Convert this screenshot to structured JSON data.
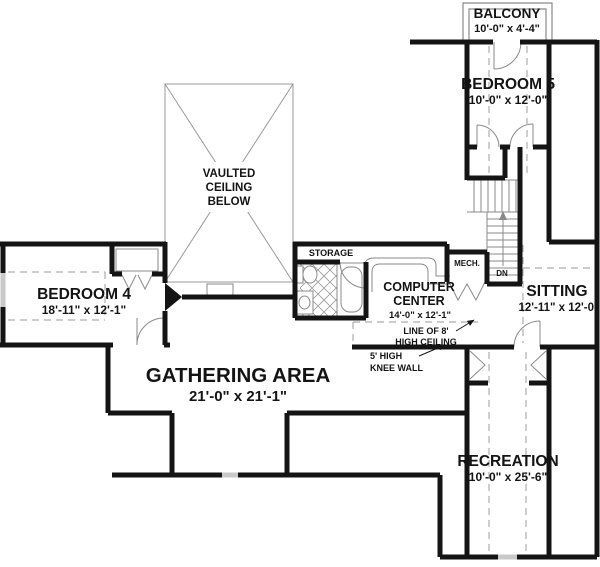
{
  "plan": {
    "rooms": {
      "balcony": {
        "name": "BALCONY",
        "dims": "10'-0\" x 4'-4\""
      },
      "bedroom5": {
        "name": "BEDROOM 5",
        "dims": "10'-0\" x 12'-0\""
      },
      "bedroom4": {
        "name": "BEDROOM 4",
        "dims": "18'-11\" x 12'-1\""
      },
      "gathering": {
        "name": "GATHERING AREA",
        "dims": "21'-0\" x 21'-1\""
      },
      "computer": {
        "name_line1": "COMPUTER",
        "name_line2": "CENTER",
        "dims": "14'-0\" x 12'-1\""
      },
      "sitting": {
        "name": "SITTING",
        "dims": "12'-11\" x 12'-0\""
      },
      "recreation": {
        "name": "RECREATION",
        "dims": "10'-0\" x 25'-6\""
      },
      "storage": {
        "name": "STORAGE"
      },
      "mech": {
        "name": "MECH."
      },
      "vaulted": {
        "line1": "VAULTED",
        "line2": "CEILING",
        "line3": "BELOW"
      }
    },
    "annotations": {
      "stairs_dn": "DN",
      "ceiling_line1": "LINE OF 8'",
      "ceiling_line2": "HIGH CEILING",
      "knee_wall1": "5' HIGH",
      "knee_wall2": "KNEE WALL"
    },
    "colors": {
      "wall": "#141414",
      "thin_line": "#8a8a8a",
      "dashed_line": "#adadad",
      "window": "#c9c9c9",
      "background": "#ffffff",
      "text": "#141414"
    }
  }
}
